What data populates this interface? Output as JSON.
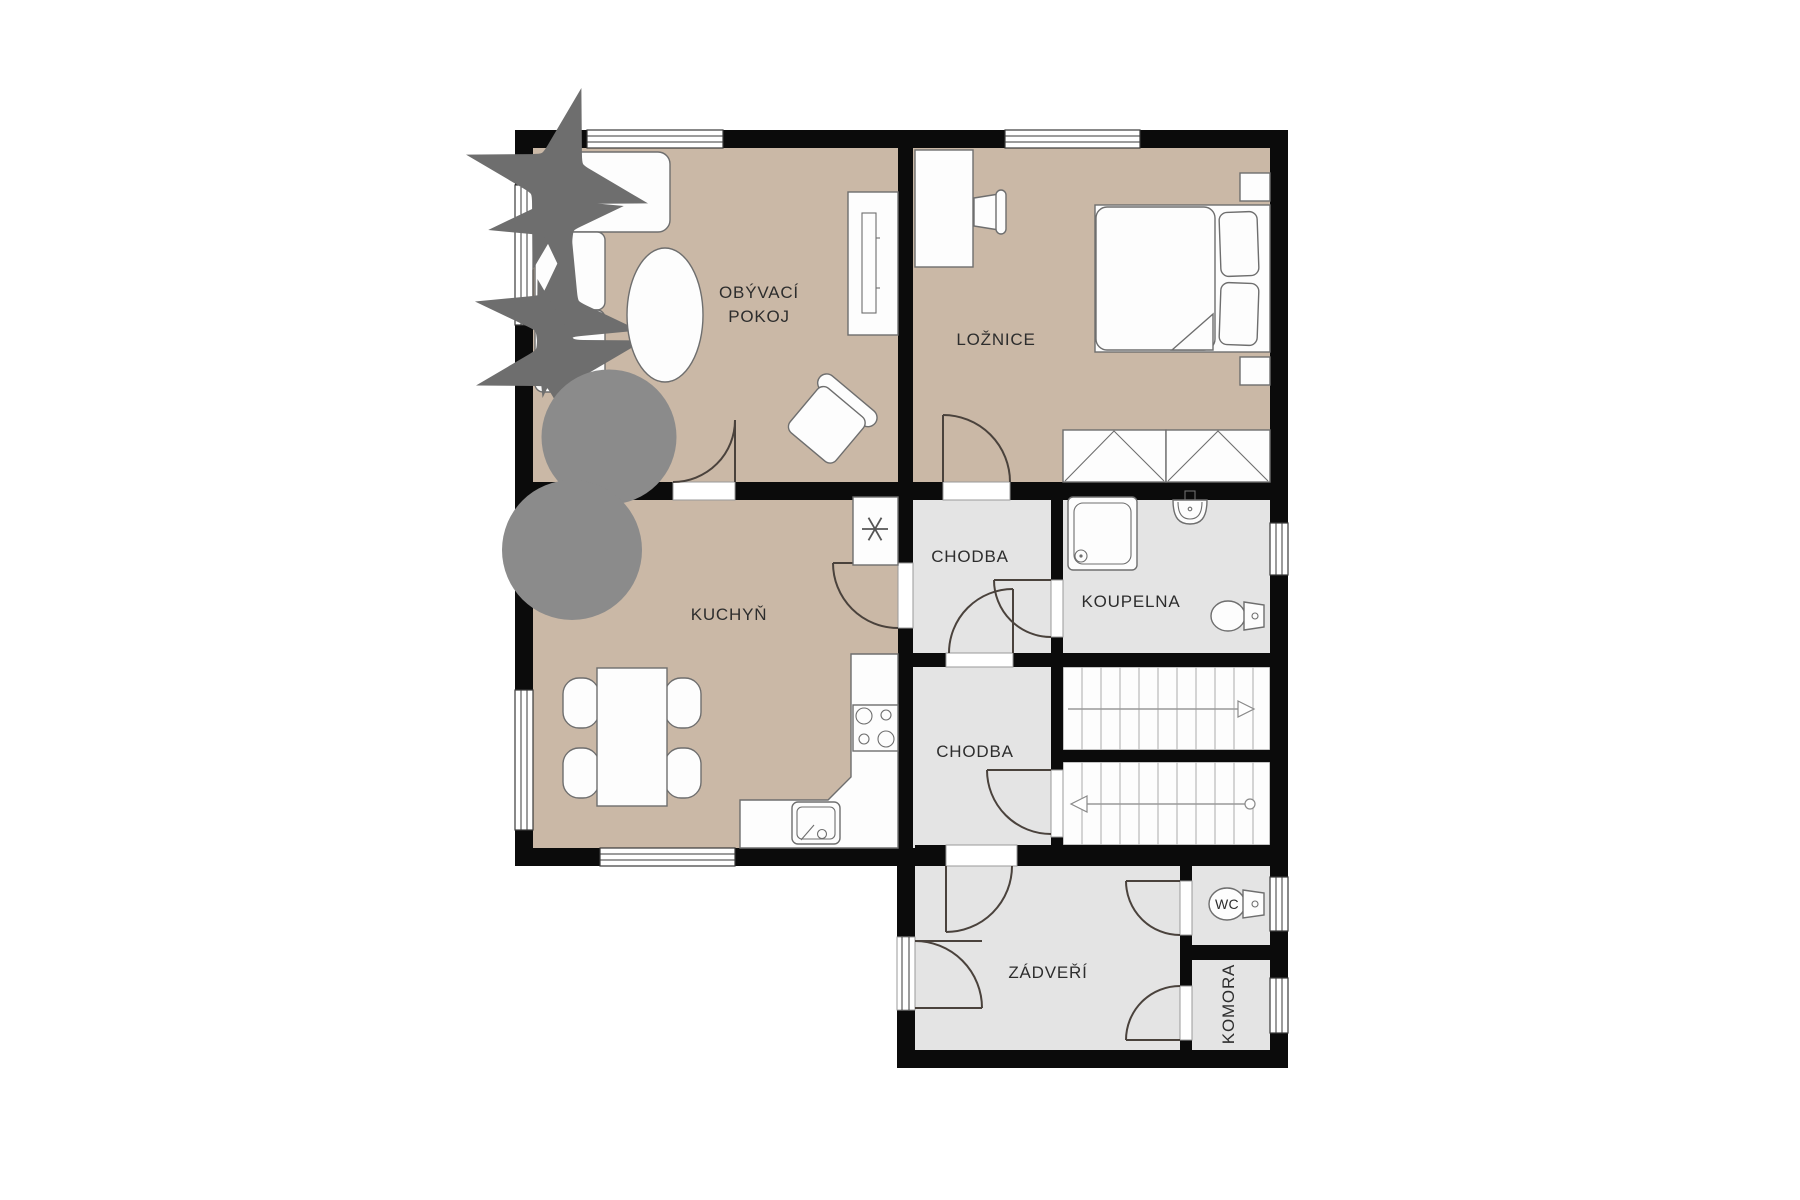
{
  "meta": {
    "type": "apartment floor plan",
    "language": "cs",
    "background": "#ffffff"
  },
  "palette": {
    "wall": "#0b0b0b",
    "floor_main": "#cab8a6",
    "floor_service": "#e4e4e4",
    "stairs_bg": "#fdfdfd",
    "furniture_stroke": "#6e6e6e",
    "door_stroke": "#4a423c",
    "window_stroke": "#3a3a3a",
    "label": "#2d2d2d"
  },
  "rooms": {
    "living": {
      "label_line1": "OBÝVACÍ",
      "label_line2": "POKOJ"
    },
    "bedroom": {
      "label": "LOŽNICE"
    },
    "kitchen": {
      "label": "KUCHYŇ"
    },
    "hall_upper": {
      "label": "CHODBA"
    },
    "bathroom": {
      "label": "KOUPELNA"
    },
    "hall_lower": {
      "label": "CHODBA"
    },
    "vestibule": {
      "label": "ZÁDVEŘÍ"
    },
    "wc": {
      "label": "WC"
    },
    "storage": {
      "label": "KOMORA"
    }
  },
  "fixtures": [
    "sofa",
    "sofa-pillows",
    "oval-coffee-table",
    "tv-cabinet",
    "armchair",
    "plant-living",
    "plant-kitchen",
    "desk",
    "desk-chair",
    "double-bed",
    "bed-pillows",
    "nightstand",
    "wardrobe",
    "dining-table",
    "dining-chair",
    "fridge",
    "kitchen-counter",
    "kitchen-sink",
    "stove",
    "shower",
    "washbasin",
    "toilet-bathroom",
    "toilet-wc",
    "stairs-flight-up",
    "stairs-flight-down",
    "entry-door"
  ]
}
